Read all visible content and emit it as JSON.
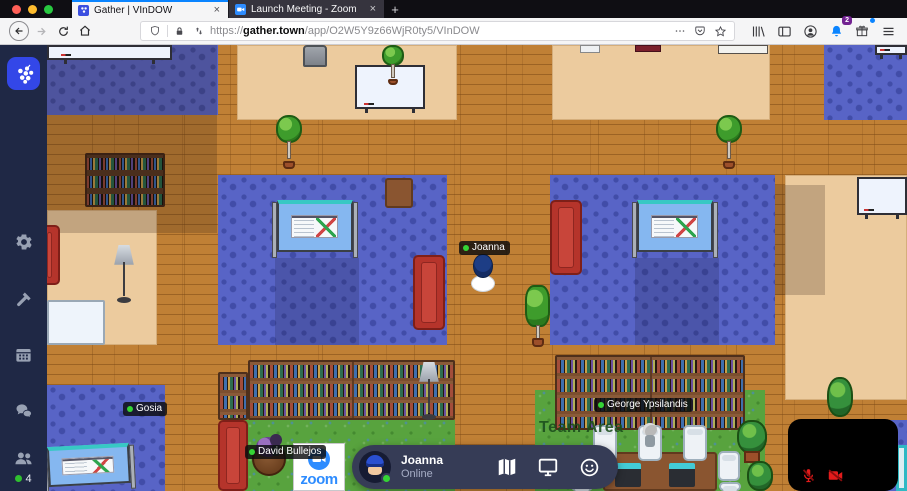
{
  "browser": {
    "tabs": [
      {
        "title": "Gather | VInDOW",
        "active": true
      },
      {
        "title": "Launch Meeting - Zoom",
        "active": false
      }
    ],
    "new_tab": "+",
    "close_glyph": "×",
    "url": {
      "scheme": "https://",
      "domain": "gather.town",
      "path": "/app/O2W5Y9z66WjR0ty5/VInDOW"
    },
    "notifications_badge": "2"
  },
  "sidebar": {
    "online_count": "4"
  },
  "game": {
    "players": {
      "joanna": {
        "name": "Joanna",
        "status": "online"
      },
      "gosia": {
        "name": "Gosia",
        "status": "online"
      },
      "david": {
        "name": "David Bullejos",
        "status": "online"
      },
      "george": {
        "name": "George Ypsilandis",
        "status": "online"
      }
    },
    "labels": {
      "team_area": "Team Area",
      "zoom_poster_text": "zoom"
    }
  },
  "control_bar": {
    "user_name": "Joanna",
    "status": "Online"
  },
  "icons": {
    "gather_logo": "grape-cluster",
    "settings": "gear",
    "build": "hammer",
    "calendar": "calendar-grid",
    "chat": "speech-bubbles",
    "participants": "two-people",
    "map": "folded-map",
    "screenshare": "monitor",
    "emote": "smiley-face",
    "mic_muted": "microphone-slash",
    "camera_muted": "video-camera-slash"
  },
  "colors": {
    "accent_blue": "#0a84ff",
    "gather_blue": "#3347e8",
    "zoom_blue": "#2d8cff",
    "status_green": "#35d435",
    "mute_red": "#e31b1b",
    "wood": "#c08035",
    "carpet": "#5864c6",
    "grass": "#58a33e",
    "room_tan": "#eccb9e",
    "sidebar_navy": "#1f2845",
    "control_bar": "#363c56"
  }
}
